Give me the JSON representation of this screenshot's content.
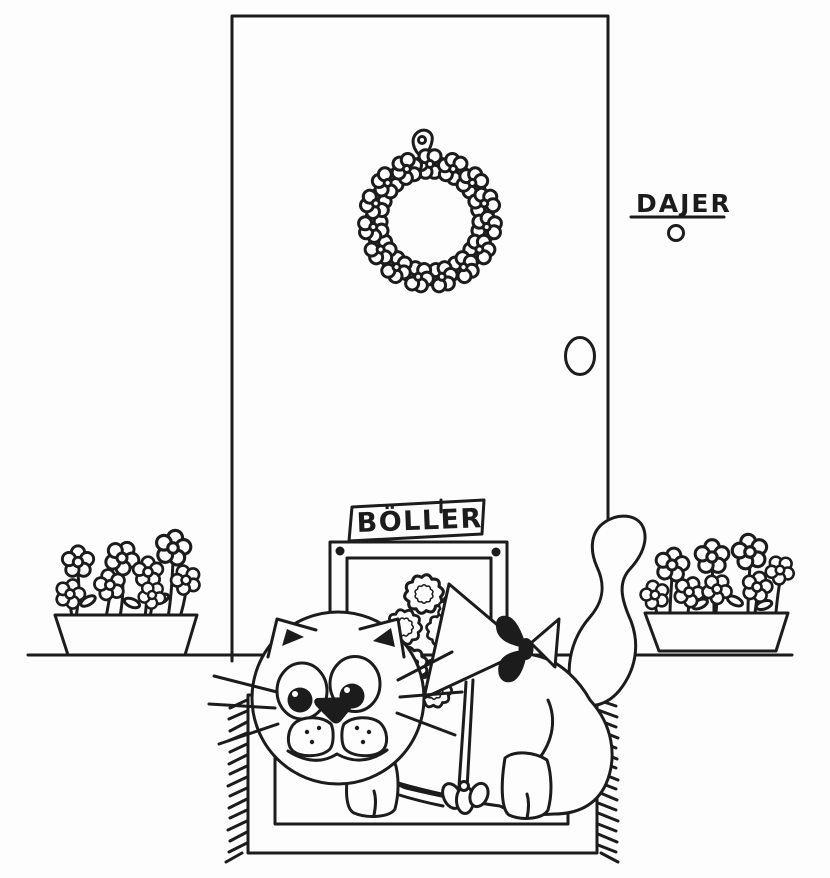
{
  "illustration": {
    "title": "Cat with flower bouquet at the front door",
    "style": "hand-drawn black ink cartoon on white paper",
    "ink_color": "#1c1c1c",
    "paper_color": "#fdfdfd",
    "name_plate": {
      "text": "DAJER"
    },
    "cat_flap_sign": {
      "text": "BÖLLER"
    },
    "objects": [
      "front-door",
      "flower-wreath",
      "wreath-hanger",
      "name-plate",
      "doorbell-button",
      "door-handle",
      "cat-flap",
      "cat-flap-sign",
      "flower-pot-left",
      "flower-pot-right",
      "ground-line",
      "doormat",
      "doormat-fringe",
      "cat",
      "cat-tail",
      "flower-bouquet",
      "bouquet-wrapping-cone",
      "ribbon-bow",
      "ribbon-string",
      "paw-bow"
    ]
  }
}
